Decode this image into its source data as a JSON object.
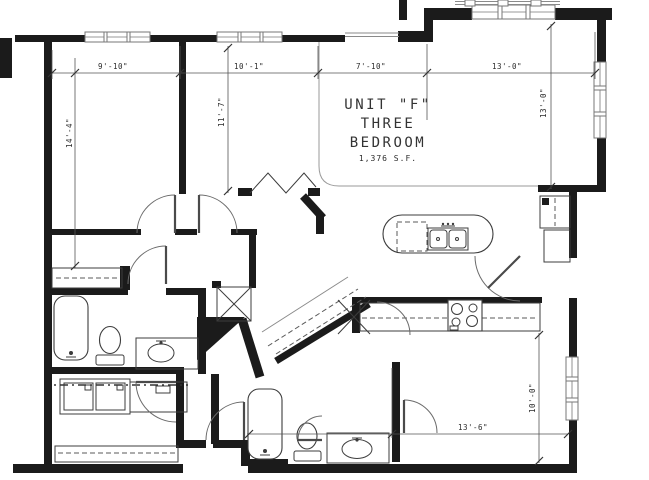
{
  "plan": {
    "title": {
      "line1": "UNIT \"F\"",
      "line2": "THREE",
      "line3": "BEDROOM",
      "area": "1,376 S.F."
    },
    "dims": {
      "bedroom1_width": "9'-10\"",
      "bedroom1_depth": "14'-4\"",
      "bedroom2_width": "10'-1\"",
      "bedroom2_depth": "11'-7\"",
      "foyer_width": "7'-10\"",
      "living_width": "13'-0\"",
      "living_depth": "13'-0\"",
      "master_width": "13'-6\"",
      "master_depth": "10'-0\""
    },
    "rooms": [
      {
        "name": "bedroom-1",
        "width": "9'-10\"",
        "depth": "14'-4\""
      },
      {
        "name": "bedroom-2",
        "width": "10'-1\"",
        "depth": "11'-7\""
      },
      {
        "name": "living-dining",
        "width": "13'-0\"",
        "depth": "13'-0\""
      },
      {
        "name": "master-bedroom",
        "width": "13'-6\"",
        "depth": "10'-0\""
      },
      {
        "name": "foyer",
        "width": "7'-10\""
      }
    ],
    "fixtures": [
      "bathtub",
      "toilet",
      "vanity-sink",
      "washer",
      "dryer",
      "kitchen-island",
      "double-sink",
      "dishwasher",
      "range",
      "bifold-closet-doors",
      "walk-in-closet-rod",
      "linen-shelf",
      "diamond-shelf-unit",
      "entry-closet",
      "door-swings",
      "windows"
    ],
    "colors": {
      "wall": "#1b1b1b",
      "line": "#555555",
      "background": "#ffffff"
    }
  }
}
